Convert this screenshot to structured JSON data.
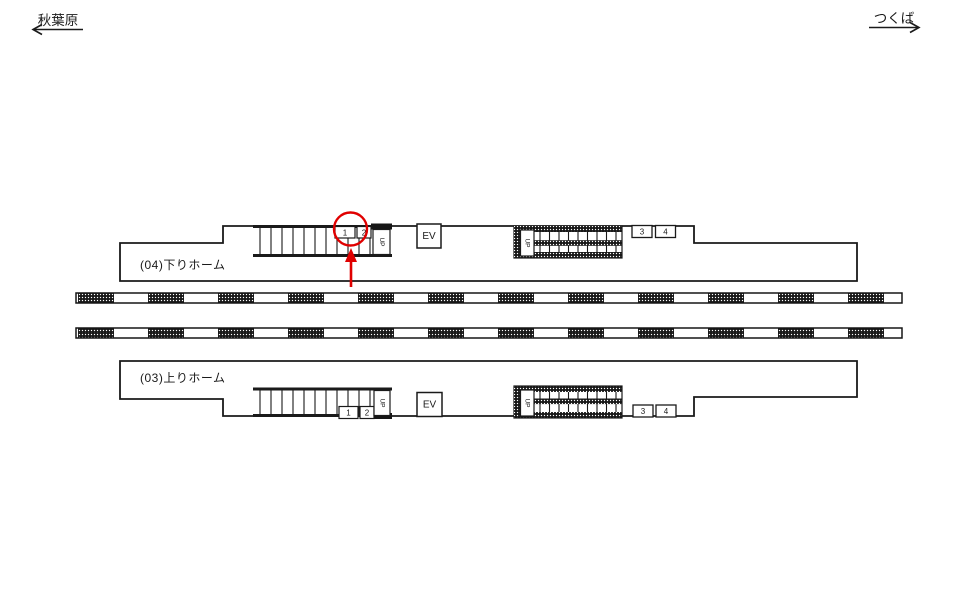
{
  "header": {
    "left_direction": "秋葉原",
    "right_direction": "つくば"
  },
  "platform_down": {
    "label": "(04)下りホーム",
    "stair_box_1": "1",
    "stair_box_2": "2",
    "stair_escalator_label": "UP",
    "elevator_label": "EV",
    "escalator_label": "UP",
    "box_3": "3",
    "box_4": "4"
  },
  "platform_up": {
    "label": "(03)上りホーム",
    "stair_box_1": "1",
    "stair_box_2": "2",
    "stair_escalator_label": "UP",
    "elevator_label": "EV",
    "escalator_label": "UP",
    "box_3": "3",
    "box_4": "4"
  },
  "colors": {
    "line": "#1a1a1a",
    "highlight": "#e00000"
  }
}
